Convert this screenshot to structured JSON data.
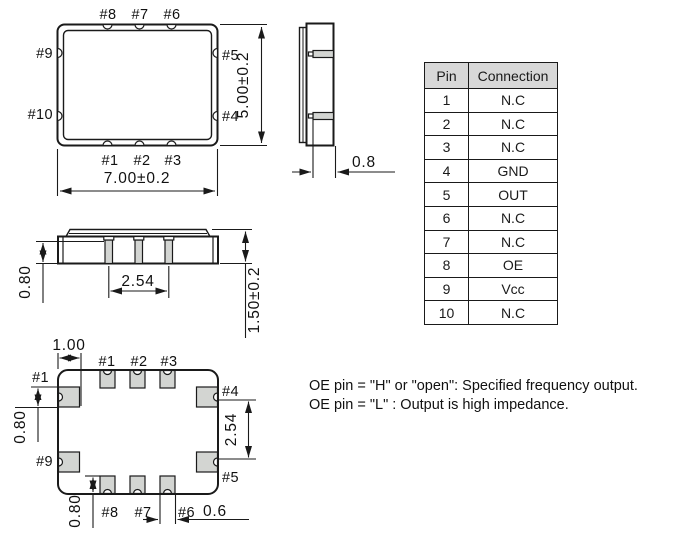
{
  "top_view": {
    "pins_top": [
      "#8",
      "#7",
      "#6"
    ],
    "pins_left": [
      "#9",
      "#10"
    ],
    "pins_right": [
      "#5",
      "#4"
    ],
    "pins_bottom": [
      "#1",
      "#2",
      "#3"
    ],
    "dim_height": "5.00±0.2",
    "dim_width": "7.00±0.2"
  },
  "side_view": {
    "dim_pad_length": "0.8"
  },
  "front_view": {
    "dim_pad_height": "0.80",
    "dim_pad_pitch": "2.54",
    "dim_body_height": "1.50±0.2"
  },
  "bottom_view": {
    "pins_top": [
      "#1",
      "#2",
      "#3"
    ],
    "pin_left_top": "#1",
    "pin_left_bottom": "#9",
    "pin_right_top": "#4",
    "pin_right_bottom": "#5",
    "pins_bottom": [
      "#8",
      "#7",
      "#6"
    ],
    "dim_corner_offset": "1.00",
    "dim_pad_height_left": "0.80",
    "dim_pad_pitch_right": "2.54",
    "dim_pad_height_bottom": "0.80",
    "dim_pad_width": "0.6"
  },
  "pin_table": {
    "headers": [
      "Pin",
      "Connection"
    ],
    "rows": [
      [
        "1",
        "N.C"
      ],
      [
        "2",
        "N.C"
      ],
      [
        "3",
        "N.C"
      ],
      [
        "4",
        "GND"
      ],
      [
        "5",
        "OUT"
      ],
      [
        "6",
        "N.C"
      ],
      [
        "7",
        "N.C"
      ],
      [
        "8",
        "OE"
      ],
      [
        "9",
        "Vcc"
      ],
      [
        "10",
        "N.C"
      ]
    ]
  },
  "notes": {
    "line1": "OE pin = \"H\" or \"open\": Specified frequency output.",
    "line2": "OE pin = \"L\" : Output is high impedance."
  },
  "colors": {
    "line": "#1a1a1a",
    "pad_fill": "#d3d5d2",
    "table_header_bg": "#d8d8d8"
  }
}
